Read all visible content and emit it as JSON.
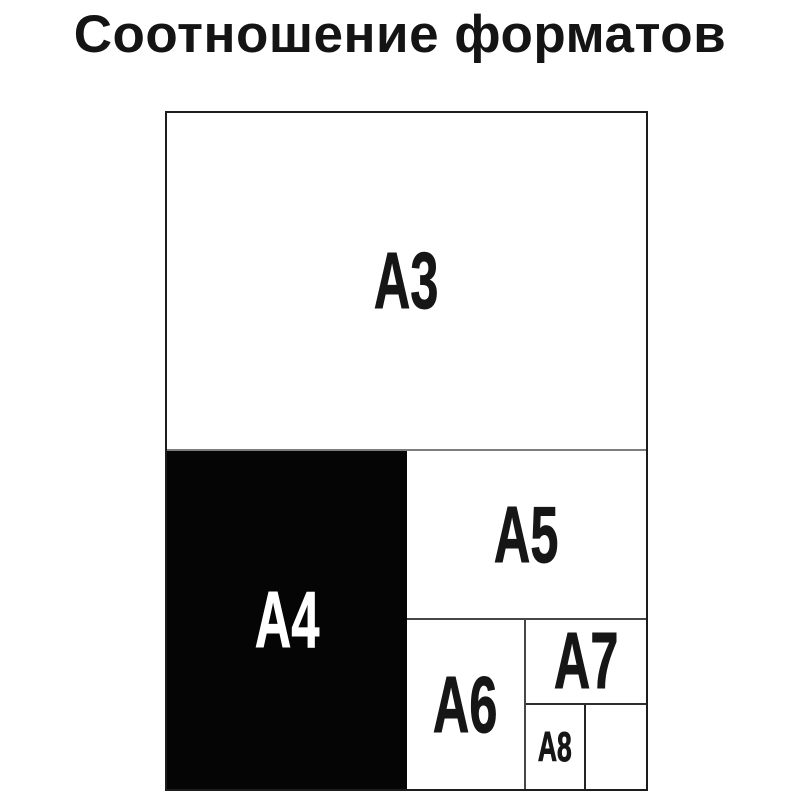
{
  "title": "Соотношение форматов",
  "colors": {
    "background": "#ffffff",
    "outline": "#1c1c1c",
    "divider_gray": "#7d7d7d",
    "divider_dark": "#474747",
    "a4_fill": "#050505",
    "label_dark": "#161616",
    "label_light": "#ffffff"
  },
  "regions": {
    "a3": {
      "label": "A3"
    },
    "a4": {
      "label": "A4"
    },
    "a5": {
      "label": "A5"
    },
    "a6": {
      "label": "A6"
    },
    "a7": {
      "label": "A7"
    },
    "a8": {
      "label": "A8"
    }
  }
}
